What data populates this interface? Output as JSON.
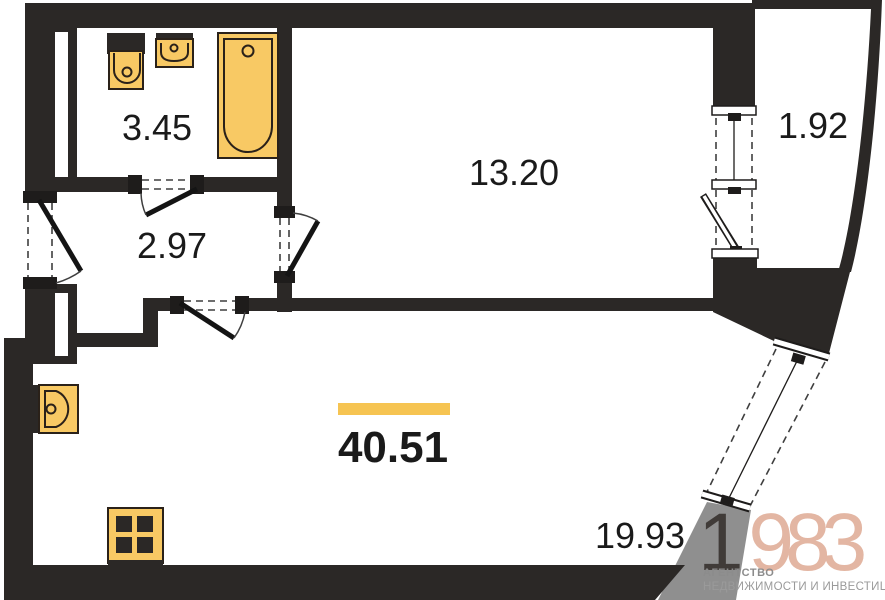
{
  "plan": {
    "type": "apartment-floor-plan",
    "total_area": "40.51",
    "rooms": {
      "bathroom": "3.45",
      "hallway": "2.97",
      "bedroom": "13.20",
      "balcony": "1.92",
      "living_kitchen": "19.93"
    },
    "fixtures": [
      "toilet-icon",
      "bath-sink-icon",
      "bathtub-icon",
      "kitchen-sink-icon",
      "stove-icon"
    ],
    "colors": {
      "wall": "#2B2826",
      "fixture_fill": "#F8C964",
      "accent_bar": "#F6C452",
      "grey_band": "#8F8F8F",
      "watermark_dark": "#403B38",
      "watermark_salmon": "#E3B6A3"
    }
  },
  "watermark": {
    "logo_digit_dark": "1",
    "logo_digits_accent": "983",
    "agency_line1": "АГЕНТСТВО",
    "agency_line2": "НЕДВИЖИМОСТИ И ИНВЕСТИЦИЙ"
  }
}
